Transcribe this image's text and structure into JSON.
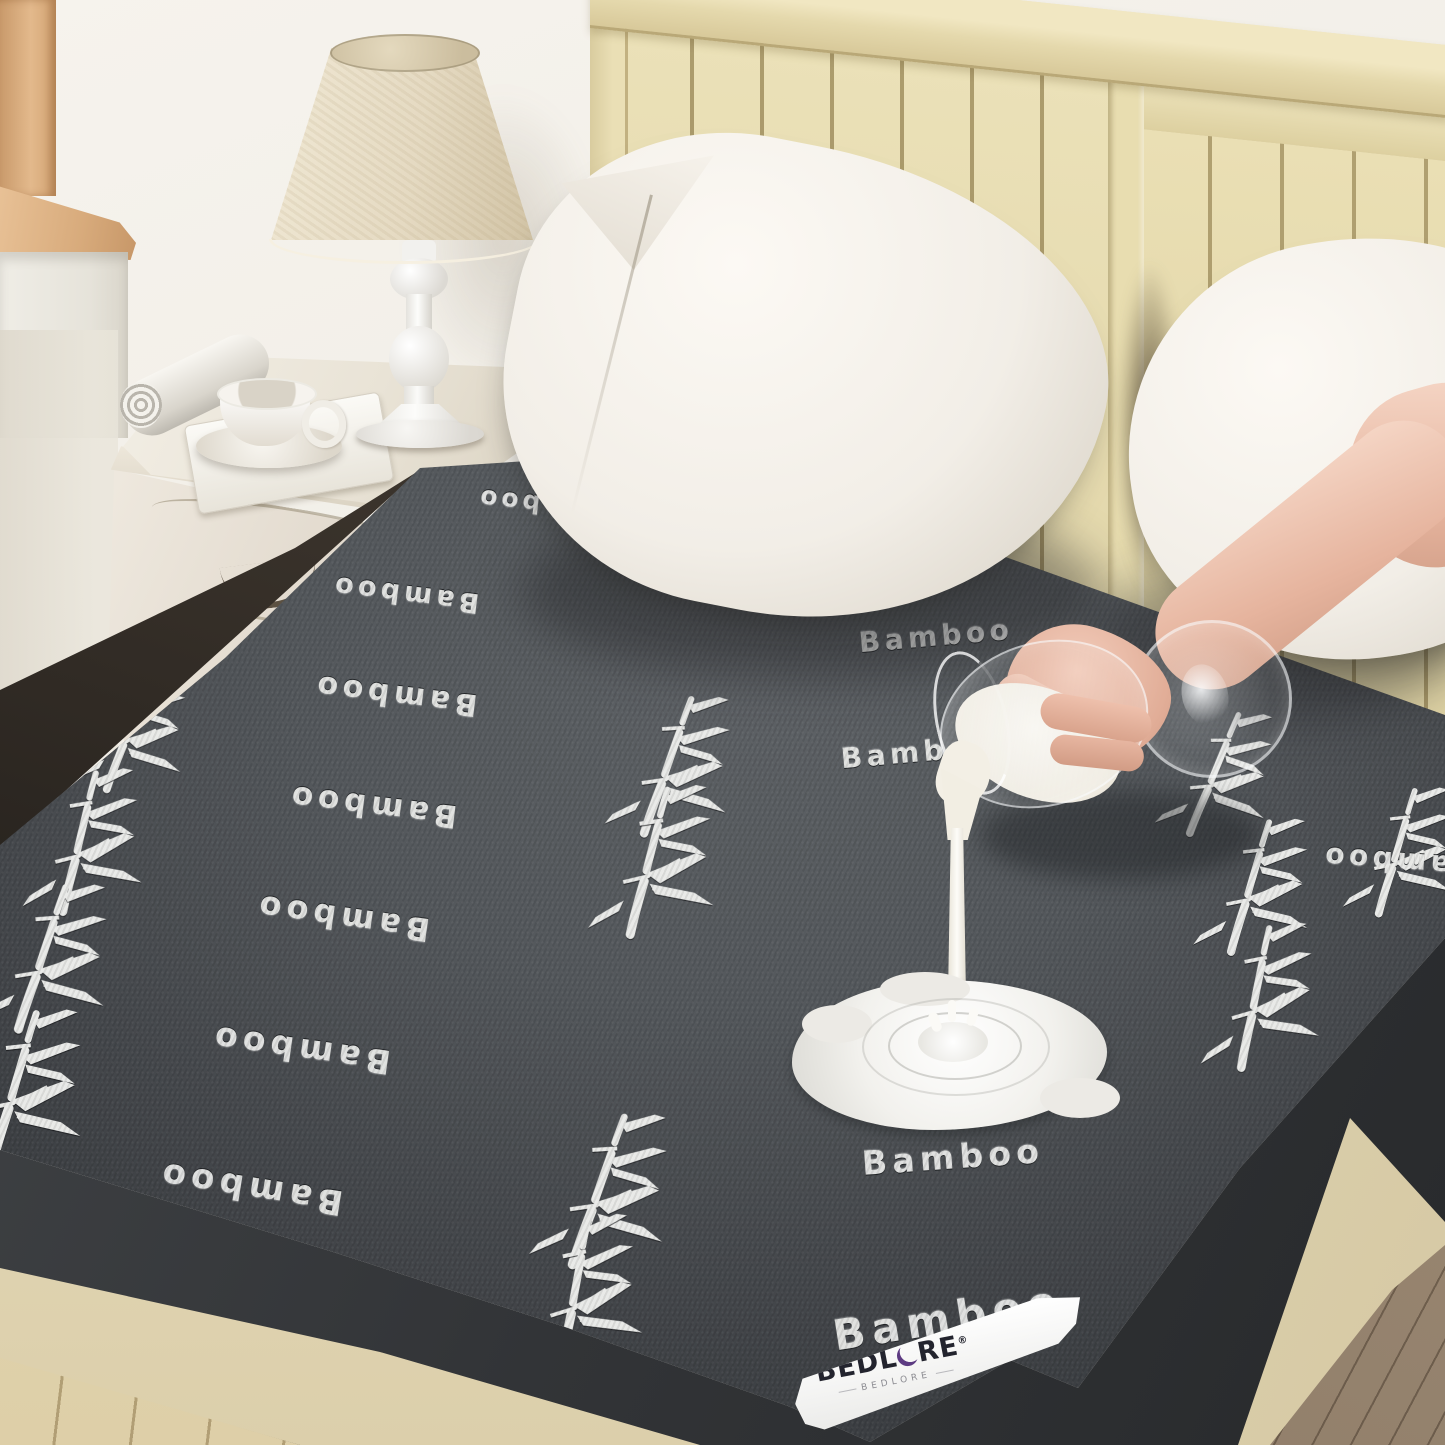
{
  "scene": {
    "description": "Bedroom product photo: dark gray bamboo-pattern waterproof mattress protector on a cream bed, hand pouring milk from a wine glass which beads into a puddle; nightstand with lamp, magazine and teacup at left",
    "colors": {
      "fabric": "#515458",
      "embroidery": "#e7e8e6",
      "headboard": "#eadfb5",
      "pillow": "#f4f0e9",
      "wall": "#f1eee7",
      "milk": "#f6f3ec",
      "skin": "#e9bfa9",
      "wood_floor": "#93816d",
      "label_accent": "#5d3b82"
    }
  },
  "label": {
    "brand_left": "BEDL",
    "brand_right": "RE",
    "reg": "®",
    "sub": "BEDLORE"
  },
  "mattress": {
    "pattern_word": "Bamboo",
    "motif": "bamboo-plant",
    "words": [
      {
        "text": "Bamboo",
        "style": "left:545px;top:505px;font-size:25px;--rot:186deg"
      },
      {
        "text": "Bamboo",
        "style": "left:405px;top:594px;font-size:27px;--rot:187deg"
      },
      {
        "text": "Bamboo",
        "style": "left:395px;top:695px;font-size:30px;--rot:187deg"
      },
      {
        "text": "Bamboo",
        "style": "left:372px;top:806px;font-size:31px;--rot:187deg"
      },
      {
        "text": "Bamboo",
        "style": "left:342px;top:918px;font-size:32px;--rot:188deg"
      },
      {
        "text": "Bamboo",
        "style": "left:300px;top:1050px;font-size:33px;--rot:188deg"
      },
      {
        "text": "Bamboo",
        "style": "left:250px;top:1188px;font-size:34px;--rot:189deg"
      },
      {
        "text": "Bamboo",
        "style": "left:1367px;top:641px;font-size:26px;--rot:184deg"
      },
      {
        "text": "Bamboo",
        "style": "left:1398px;top:862px;font-size:28px;--rot:184deg"
      },
      {
        "text": "Bamboo",
        "style": "left:1432px;top:1098px;font-size:30px;--rot:184deg"
      },
      {
        "text": "Bamboo",
        "style": "left:878px;top:544px;font-size:25px;--rot:-6deg"
      },
      {
        "text": "Bamboo",
        "style": "left:936px;top:636px;font-size:28px;--rot:-5deg"
      },
      {
        "text": "Bamboo",
        "style": "left:918px;top:752px;font-size:28px;--rot:-5deg"
      },
      {
        "text": "Bamboo",
        "style": "left:953px;top:1157px;font-size:33px;--rot:-4deg"
      },
      {
        "text": "Bamboo",
        "style": "left:948px;top:1318px;font-size:42px;--rot:-9deg"
      }
    ],
    "plants": [
      {
        "style": "left:140px;top:733px;--s:0.9;--rot:4deg"
      },
      {
        "style": "left:92px;top:845px;--s:1;--rot:-3deg"
      },
      {
        "style": "left:55px;top:962px;--s:1.05;--rot:2deg"
      },
      {
        "style": "left:28px;top:1092px;--s:1.1;--rot:0deg"
      },
      {
        "style": "left:705px;top:525px;--s:0.85;--rot:-4deg"
      },
      {
        "style": "left:680px;top:770px;--s:1;--rot:3deg"
      },
      {
        "style": "left:662px;top:865px;--s:1.05;--rot:-2deg"
      },
      {
        "style": "left:1225px;top:778px;--s:0.9;--rot:6deg"
      },
      {
        "style": "left:1262px;top:890px;--s:0.95;--rot:0deg"
      },
      {
        "style": "left:1268px;top:1000px;--s:1;--rot:-5deg"
      },
      {
        "style": "left:612px;top:1195px;--s:1.1;--rot:3deg"
      },
      {
        "style": "left:588px;top:1296px;--s:1.05;--rot:-6deg"
      },
      {
        "style": "left:1408px;top:855px;--s:0.9;--rot:0deg"
      }
    ]
  }
}
